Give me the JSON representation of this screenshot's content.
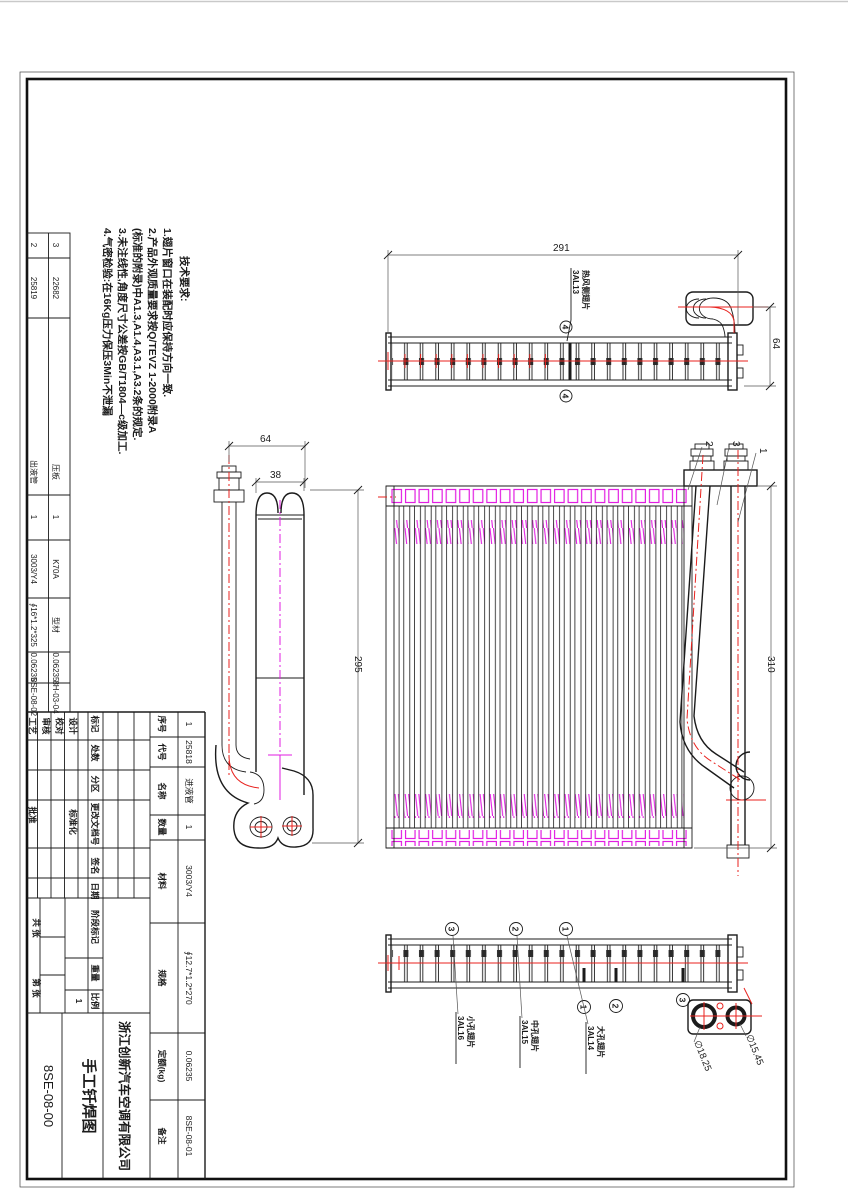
{
  "notes": {
    "title": "技术要求:",
    "lines": [
      "1.翅片窗口在装配时应保持方向一致.",
      "2.产品外观质量要求按Q/TEVZ 1-2000附录A",
      "(标准的附录)中A1.3,A1.4,A3.1,A3.2条的规定.",
      "3.未注线性,角度尺寸公差按GB/T1804—c级加工.",
      "4.气密检验:在16Kg压力保压3Min不泄漏"
    ]
  },
  "bom": {
    "headers": {
      "seq": "序号",
      "code": "代号",
      "name": "名称",
      "qty": "数量",
      "material": "材料",
      "spec": "规格",
      "quota": "定额(kg)",
      "remark": "备注"
    },
    "rows": [
      {
        "seq": "1",
        "code": "25818",
        "name": "进液管",
        "qty": "1",
        "material": "3003/Y4",
        "spec": "∮12.7*1.2*270",
        "quota": "0.06235",
        "remark": "8SE-08-01"
      },
      {
        "seq": "2",
        "code": "25819",
        "name": "出液管",
        "qty": "1",
        "material": "3003/Y4",
        "spec": "∮16*1.2*325",
        "quota": "0.06235",
        "remark": "8SE-08-02"
      },
      {
        "seq": "3",
        "code": "22682",
        "name": "压板",
        "qty": "1",
        "material": "K70A",
        "spec": "型材",
        "quota": "0.06235",
        "remark": "8H-03-04"
      }
    ]
  },
  "title_block": {
    "company": "浙江创新汽车空调有限公司",
    "drawing_title": "手工钎焊图",
    "drawing_number": "8SE-08-00",
    "fields": {
      "mark": "标记",
      "count": "处数",
      "zone": "分区",
      "doc": "更改文档号",
      "sign": "签名",
      "date": "日期",
      "design": "设计",
      "proof": "校对",
      "audit": "审核",
      "craft": "工艺",
      "std": "标准化",
      "approve": "批准",
      "stage": "阶段标记",
      "weight": "重量",
      "scale": "比例",
      "scale_value": "1",
      "sheets_total": "共 张",
      "sheet_no": "第 张"
    }
  },
  "dimensions": {
    "top_width": "291",
    "top_height": "64",
    "side_spacing": "64",
    "tube_width": "38",
    "core_height": "295",
    "total_height": "310",
    "port_large": "∅18.25",
    "port_small": "∅15.45"
  },
  "callouts": {
    "c1": "1",
    "c2": "2",
    "c3": "3",
    "c4": "4"
  },
  "fins": {
    "f1": {
      "name": "大孔翅片",
      "code": "3AL14"
    },
    "f2": {
      "name": "中孔翅片",
      "code": "3AL15"
    },
    "f3": {
      "name": "小孔翅片",
      "code": "3AL16"
    },
    "f4": {
      "name": "热风侧翅片",
      "code": "3AL13"
    }
  },
  "colors": {
    "line": "#1b1b1b",
    "red": "#e8221e",
    "magenta": "#e21ee2"
  }
}
